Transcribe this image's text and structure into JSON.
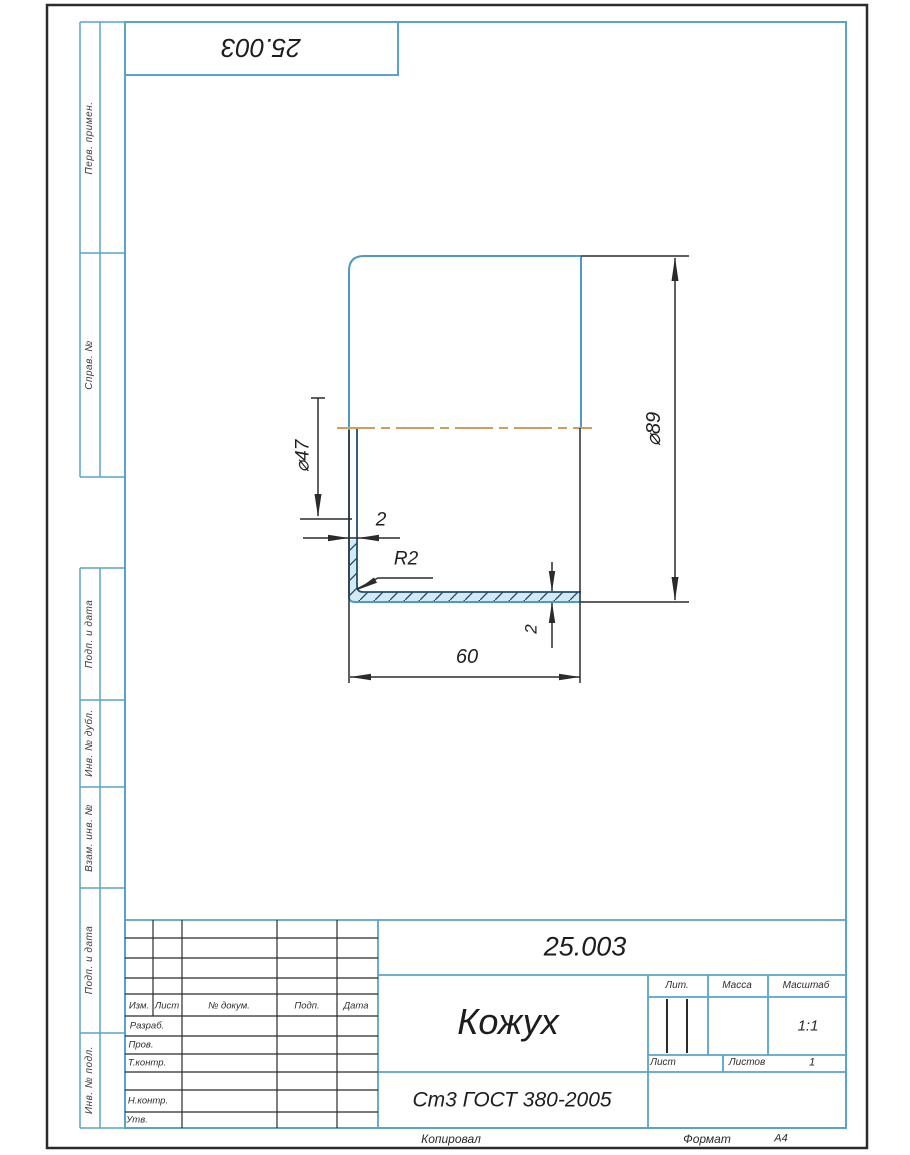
{
  "page": {
    "top_stamp": "25.003",
    "copied": "Копировал",
    "format_label": "Формат",
    "format_value": "А4"
  },
  "margin_labels": [
    "Перв. примен.",
    "Справ. №",
    "Подп. и дата",
    "Инв. № дубл.",
    "Взам. инв. №",
    "Подп. и дата",
    "Инв. № подл."
  ],
  "drawing": {
    "dimensions": {
      "inner_diameter": "⌀47",
      "outer_diameter": "⌀89",
      "wall_thickness": "2",
      "fillet_radius": "R2",
      "bottom_thickness": "2",
      "length": "60"
    },
    "colors": {
      "outline_blue": "#4f9ac4",
      "section_edge": "#1f4e6e",
      "centerline_orange": "#d49a5e",
      "hatch_fill": "#d2eaf6",
      "frame_blue": "#58a3cc",
      "dimension_dark": "#2b2b2b"
    }
  },
  "title_block": {
    "doc_number": "25.003",
    "part_name": "Кожух",
    "material": "Ст3 ГОСТ 380-2005",
    "scale": "1:1",
    "sheets_count": "1",
    "col_izm": "Изм.",
    "col_list": "Лист",
    "col_doc": "№ докум.",
    "col_podp": "Подп.",
    "col_data": "Дата",
    "row_razrab": "Разраб.",
    "row_prov": "Пров.",
    "row_tkontr": "Т.контр.",
    "row_nkontr": "Н.контр.",
    "row_utv": "Утв.",
    "lit": "Лит.",
    "massa": "Масса",
    "masshtab": "Масштаб",
    "list": "Лист",
    "listov": "Листов"
  }
}
